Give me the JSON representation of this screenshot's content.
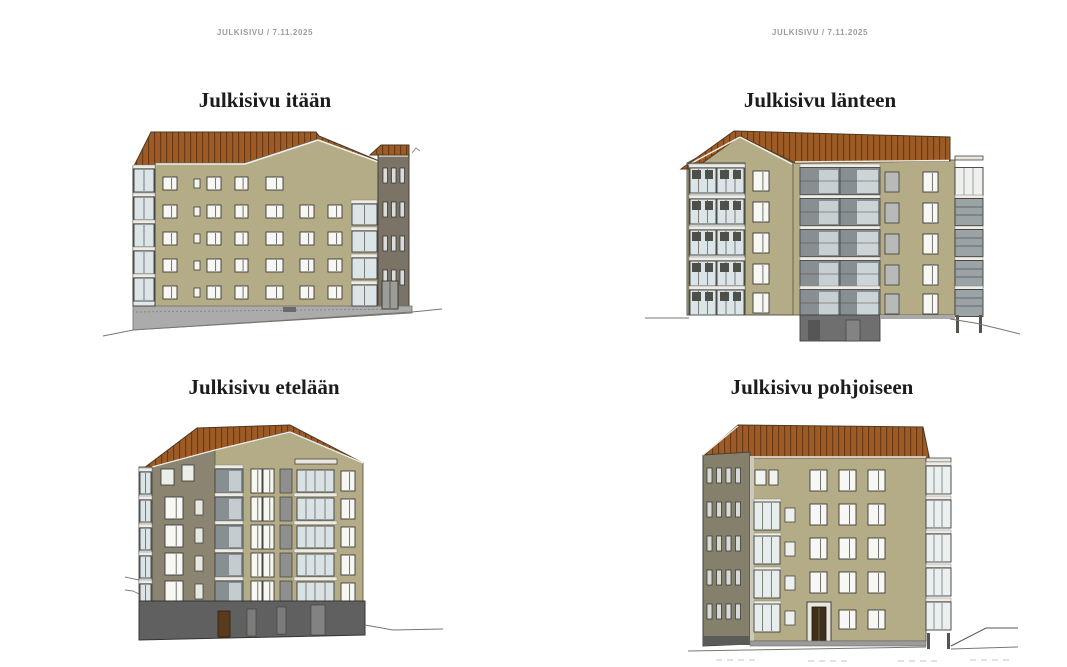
{
  "headers": {
    "left": {
      "text": "JULKISIVU / 7.11.2025"
    },
    "right": {
      "text": "JULKISIVU / 7.11.2025"
    }
  },
  "elevations": [
    {
      "id": "east",
      "title": "Julkisivu itään"
    },
    {
      "id": "west",
      "title": "Julkisivu länteen"
    },
    {
      "id": "south",
      "title": "Julkisivu etelään"
    },
    {
      "id": "north",
      "title": "Julkisivu pohjoiseen"
    }
  ],
  "colors": {
    "background": "#ffffff",
    "header_text": "#9b9b9b",
    "title_text": "#1c1c1c",
    "roof": "#9d5c27",
    "roof_seam": "#6b3a12",
    "wall_tan": "#b4ab87",
    "wall_shaded": "#8a8471",
    "wall_dark": "#7b7365",
    "wall_gable_north": "#85806c",
    "glass": "#dbe5e8",
    "balcony_recessed": "#878f92",
    "basement_dark": "#606060",
    "plinth": "#ababab",
    "window_frame": "#3b3b37",
    "ground_line": "#77776f"
  }
}
